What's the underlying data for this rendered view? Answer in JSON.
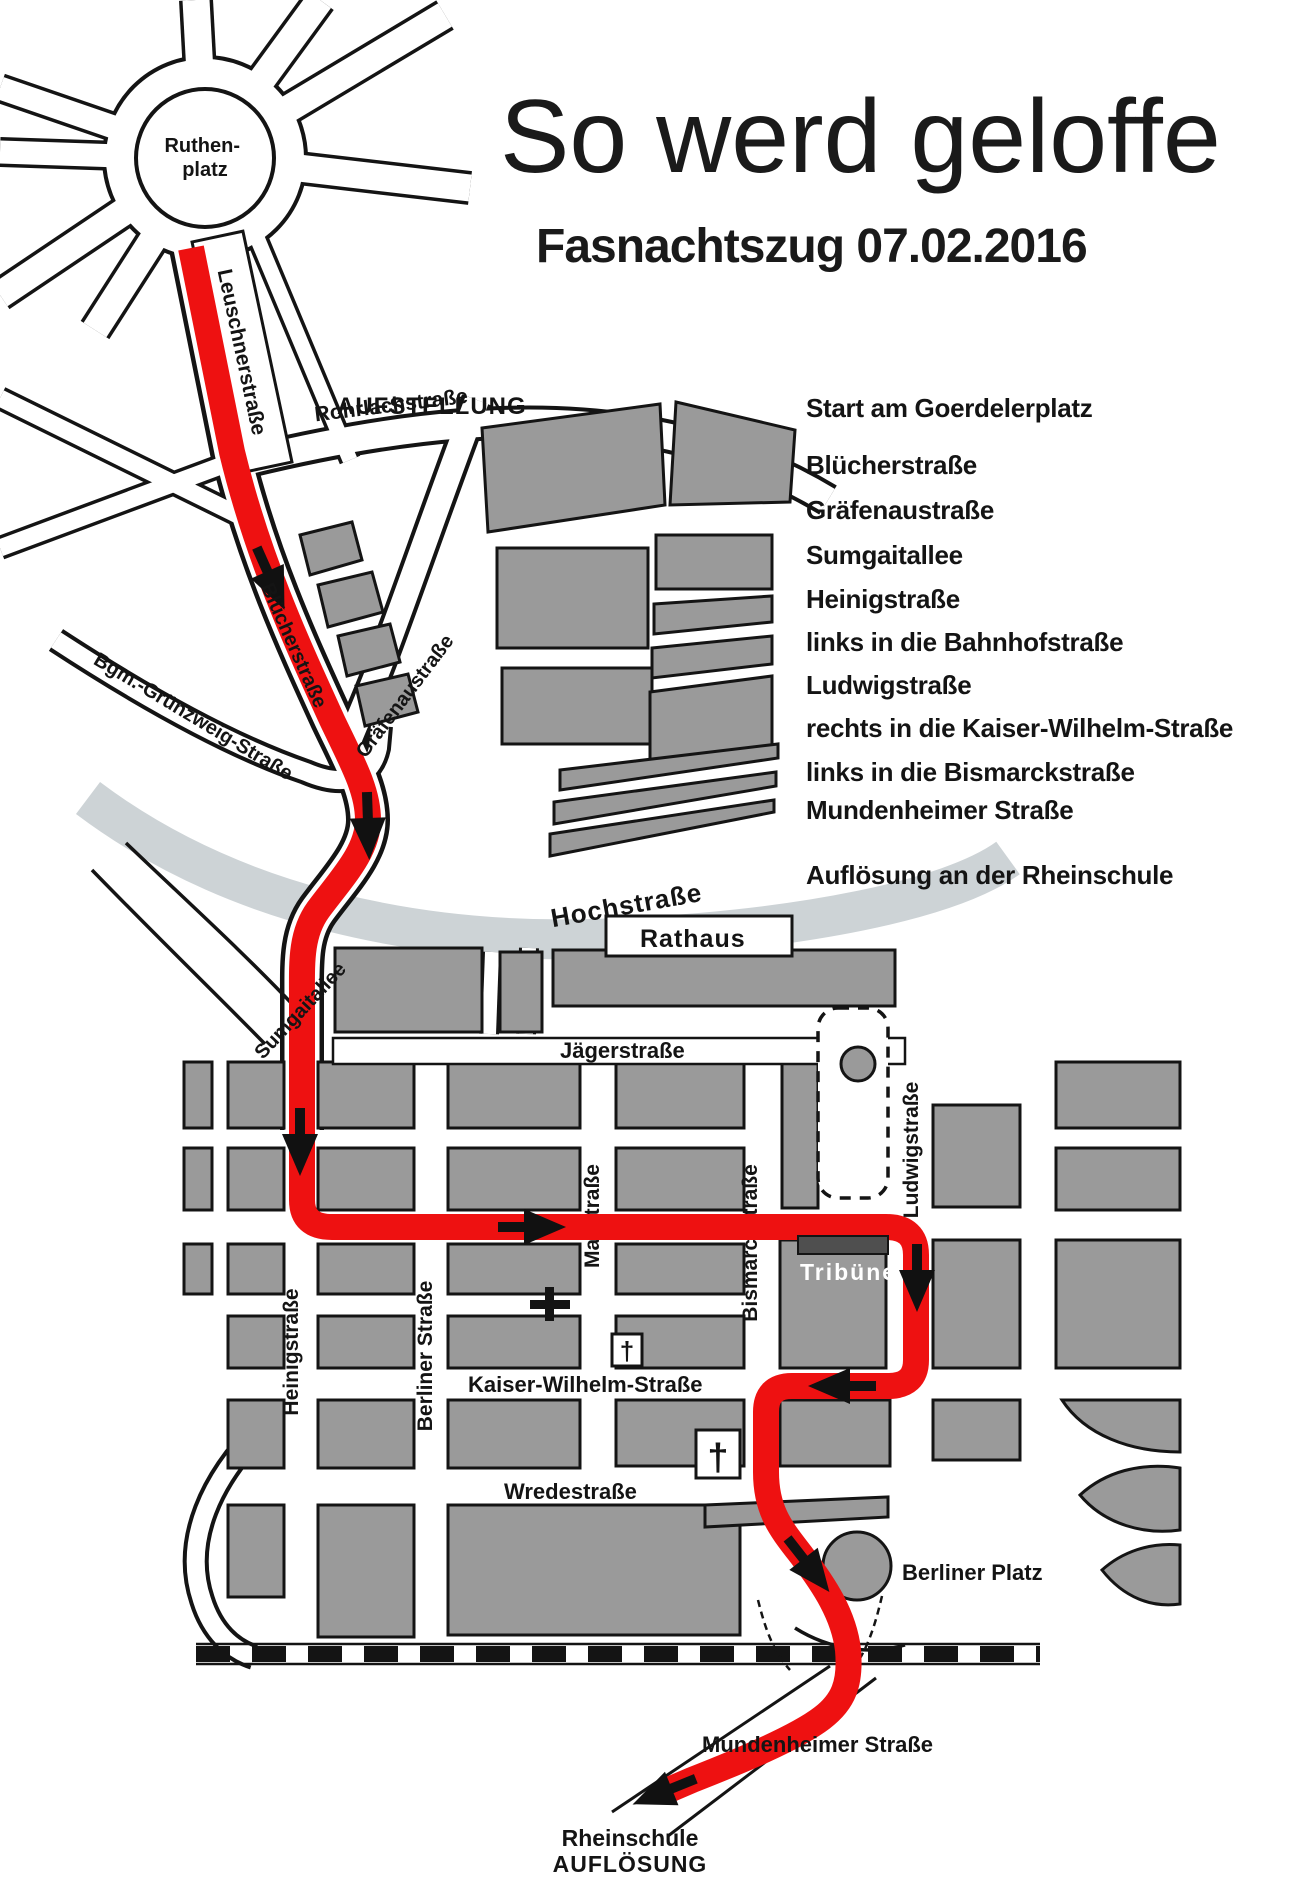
{
  "header": {
    "title": "So werd geloffe",
    "subtitle": "Fasnachtszug  07.02.2016"
  },
  "route_list": {
    "items": [
      "Start am Goerdelerplatz",
      "Blücherstraße",
      "Gräfenaustraße",
      "Sumgaitallee",
      "Heinigstraße",
      "links in die Bahnhofstraße",
      "Ludwigstraße",
      "rechts in die Kaiser-Wilhelm-Straße",
      "links in die Bismarckstraße",
      "Mundenheimer Straße",
      "Auflösung an der Rheinschule"
    ]
  },
  "map": {
    "labels": {
      "ruthenplatz_line1": "Ruthen-",
      "ruthenplatz_line2": "platz",
      "leuschnerstrasse": "Leuschnerstraße",
      "aufstellung": "AUFSTELLUNG",
      "rohrlachstrasse": "Rohrlachstraße",
      "bluecherstrasse": "Blücherstraße",
      "graefenaustrasse": "Gräfenaustraße",
      "bgm_gruenzweig": "Bgm.-Grünzweig-Straße",
      "sumgaitallee": "Sumgaitallee",
      "hochstrasse": "Hochstraße",
      "rathaus": "Rathaus",
      "jaegerstrasse": "Jägerstraße",
      "bahnhofstrasse": "Bahnhofstraße",
      "maxstrasse": "Maxstraße",
      "bismarckstrasse": "Bismarckstraße",
      "ludwigstrasse": "Ludwigstraße",
      "heinigstrasse": "Heinigstraße",
      "berliner_strasse": "Berliner Straße",
      "kaiser_wilhelm": "Kaiser-Wilhelm-Straße",
      "wredestrasse": "Wredestraße",
      "tribuene": "Tribüne",
      "berliner_platz": "Berliner Platz",
      "mundenheimer_strasse": "Mundenheimer Straße",
      "rheinschule": "Rheinschule",
      "aufloesung": "AUFLÖSUNG"
    },
    "symbols": {
      "church": "†"
    },
    "colors": {
      "route_red": "#ee1111",
      "building_gray": "#9a9a9a",
      "hochstrasse_band": "#cdd3d6",
      "tribuene_bar": "#4f4f4f"
    }
  }
}
